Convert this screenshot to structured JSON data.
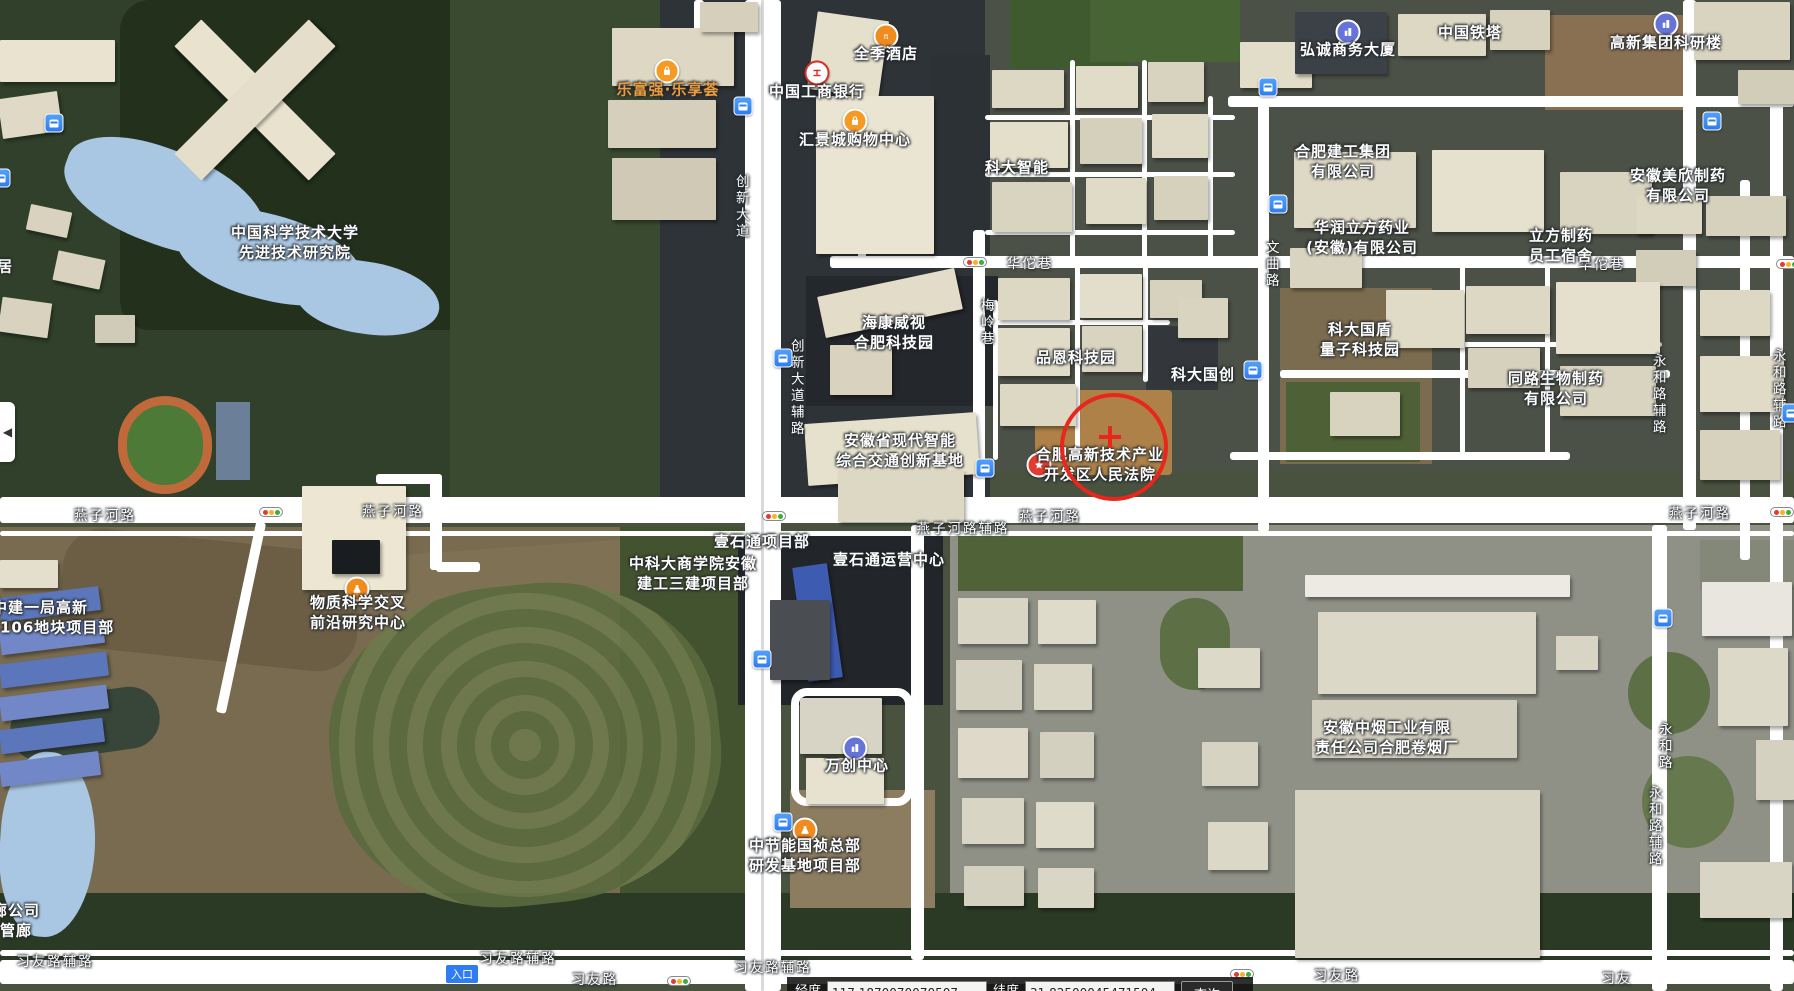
{
  "map": {
    "poi_labels": [
      {
        "lines": [
          "中国科学技术大学",
          "先进技术研究院"
        ],
        "x": 295,
        "y": 243
      },
      {
        "lines": [
          "乐富强·乐享荟"
        ],
        "x": 668,
        "y": 90,
        "color": "#eb9c3e",
        "icon": "shop",
        "ix": 667,
        "iy": 71
      },
      {
        "lines": [
          "全季酒店"
        ],
        "x": 886,
        "y": 54,
        "icon": "hotel",
        "ix": 886,
        "iy": 36
      },
      {
        "lines": [
          "中国工商银行"
        ],
        "x": 817,
        "y": 92,
        "icon": "bank",
        "ix": 817,
        "iy": 73
      },
      {
        "lines": [
          "汇景城购物中心"
        ],
        "x": 855,
        "y": 140,
        "icon": "shop",
        "ix": 855,
        "iy": 121
      },
      {
        "lines": [
          "科大智能"
        ],
        "x": 1017,
        "y": 168
      },
      {
        "lines": [
          "弘诚商务大厦"
        ],
        "x": 1348,
        "y": 50,
        "icon": "building",
        "ix": 1348,
        "iy": 32
      },
      {
        "lines": [
          "中国铁塔"
        ],
        "x": 1470,
        "y": 33
      },
      {
        "lines": [
          "高新集团科研楼"
        ],
        "x": 1666,
        "y": 43,
        "icon": "building",
        "ix": 1666,
        "iy": 24
      },
      {
        "lines": [
          "合肥建工集团",
          "有限公司"
        ],
        "x": 1343,
        "y": 162
      },
      {
        "lines": [
          "华润立方药业",
          "(安徽)有限公司"
        ],
        "x": 1362,
        "y": 238
      },
      {
        "lines": [
          "立方制药",
          "员工宿舍"
        ],
        "x": 1561,
        "y": 246
      },
      {
        "lines": [
          "安徽美欣制药",
          "有限公司"
        ],
        "x": 1678,
        "y": 186
      },
      {
        "lines": [
          "海康威视",
          "合肥科技园"
        ],
        "x": 894,
        "y": 333
      },
      {
        "lines": [
          "品恩科技园"
        ],
        "x": 1076,
        "y": 358
      },
      {
        "lines": [
          "科大国创"
        ],
        "x": 1203,
        "y": 375
      },
      {
        "lines": [
          "科大国盾",
          "量子科技园"
        ],
        "x": 1360,
        "y": 340
      },
      {
        "lines": [
          "同路生物制药",
          "有限公司"
        ],
        "x": 1556,
        "y": 389
      },
      {
        "lines": [
          "安徽省现代智能",
          "综合交通创新基地"
        ],
        "x": 900,
        "y": 451
      },
      {
        "lines": [
          "合肥高新技术产业",
          "开发区人民法院"
        ],
        "x": 1100,
        "y": 465,
        "icon": "court",
        "ix": 1039,
        "iy": 465
      },
      {
        "lines": [
          "物质科学交叉",
          "前沿研究中心"
        ],
        "x": 358,
        "y": 613,
        "icon": "flask",
        "ix": 357,
        "iy": 589
      },
      {
        "lines": [
          "中建一局高新",
          "202106地块项目部"
        ],
        "x": 40,
        "y": 618
      },
      {
        "lines": [
          "中科大商学院安徽",
          "建工三建项目部"
        ],
        "x": 693,
        "y": 574
      },
      {
        "lines": [
          "壹石通项目部"
        ],
        "x": 762,
        "y": 542
      },
      {
        "lines": [
          "壹石通运营中心"
        ],
        "x": 889,
        "y": 560
      },
      {
        "lines": [
          "万创中心"
        ],
        "x": 857,
        "y": 766,
        "icon": "building",
        "ix": 855,
        "iy": 748
      },
      {
        "lines": [
          "中节能国祯总部",
          "研发基地项目部"
        ],
        "x": 805,
        "y": 856,
        "icon": "flask",
        "ix": 805,
        "iy": 830
      },
      {
        "lines": [
          "安徽中烟工业有限",
          "责任公司合肥卷烟厂"
        ],
        "x": 1387,
        "y": 738
      },
      {
        "lines": [
          "廊公司",
          "管廊"
        ],
        "x": 16,
        "y": 921
      },
      {
        "lines": [
          "居"
        ],
        "x": 5,
        "y": 267
      }
    ],
    "road_labels": [
      {
        "text": "燕子河路",
        "x": 105,
        "y": 517
      },
      {
        "text": "燕子河路",
        "x": 393,
        "y": 513
      },
      {
        "text": "燕子河路",
        "x": 1050,
        "y": 518
      },
      {
        "text": "燕子河路",
        "x": 1700,
        "y": 515
      },
      {
        "text": "燕子河路辅路",
        "x": 963,
        "y": 530
      },
      {
        "text": "华佗巷",
        "x": 1030,
        "y": 265
      },
      {
        "text": "华佗巷",
        "x": 1602,
        "y": 266
      },
      {
        "text": "习友路辅路",
        "x": 55,
        "y": 963
      },
      {
        "text": "习友路辅路",
        "x": 518,
        "y": 960
      },
      {
        "text": "习友路辅路",
        "x": 773,
        "y": 969
      },
      {
        "text": "习友路",
        "x": 595,
        "y": 981
      },
      {
        "text": "习友路",
        "x": 1337,
        "y": 977
      },
      {
        "text": "习友",
        "x": 1617,
        "y": 980
      },
      {
        "text": "创新大道",
        "x": 740,
        "y": 207,
        "vertical": true
      },
      {
        "text": "创新大道辅路",
        "x": 795,
        "y": 388,
        "vertical": true
      },
      {
        "text": "梅岭巷",
        "x": 985,
        "y": 323,
        "vertical": true
      },
      {
        "text": "文曲路",
        "x": 1270,
        "y": 265,
        "vertical": true
      },
      {
        "text": "永和路辅路",
        "x": 1657,
        "y": 395,
        "vertical": true
      },
      {
        "text": "永和路",
        "x": 1663,
        "y": 747,
        "vertical": true
      },
      {
        "text": "永和路辅路",
        "x": 1653,
        "y": 827,
        "vertical": true
      },
      {
        "text": "永和路辅路",
        "x": 1777,
        "y": 390,
        "vertical": true
      }
    ],
    "bus_stops": [
      {
        "x": 54,
        "y": 123
      },
      {
        "x": 1,
        "y": 178
      },
      {
        "x": 743,
        "y": 106
      },
      {
        "x": 1268,
        "y": 87
      },
      {
        "x": 1278,
        "y": 204
      },
      {
        "x": 1712,
        "y": 121
      },
      {
        "x": 783,
        "y": 358
      },
      {
        "x": 985,
        "y": 468
      },
      {
        "x": 1253,
        "y": 370
      },
      {
        "x": 762,
        "y": 659
      },
      {
        "x": 783,
        "y": 822
      },
      {
        "x": 1663,
        "y": 618
      },
      {
        "x": 1791,
        "y": 413
      }
    ],
    "traffic_lights": [
      {
        "x": 975,
        "y": 262
      },
      {
        "x": 271,
        "y": 512
      },
      {
        "x": 774,
        "y": 516
      },
      {
        "x": 679,
        "y": 981
      },
      {
        "x": 1242,
        "y": 974
      },
      {
        "x": 1788,
        "y": 264
      },
      {
        "x": 1782,
        "y": 512
      }
    ],
    "entrance_badges": [
      {
        "text": "入口",
        "x": 462,
        "y": 974
      }
    ],
    "marker": {
      "cx": 1110,
      "cy": 443,
      "r": 50
    },
    "icon_colors": {
      "shop": "#f59a23",
      "hotel": "#f08c1e",
      "bank": "#ffffff",
      "building": "#6674d8",
      "flask": "#f08c1e",
      "court": "#e23c30"
    }
  },
  "panel_toggle": {
    "arrow": "◀"
  },
  "coord_bar": {
    "lng_label": "经度",
    "lng_value": "117.1870070070507",
    "lat_label": "纬度",
    "lat_value": "31.82500045471504",
    "query_label": "查询"
  }
}
